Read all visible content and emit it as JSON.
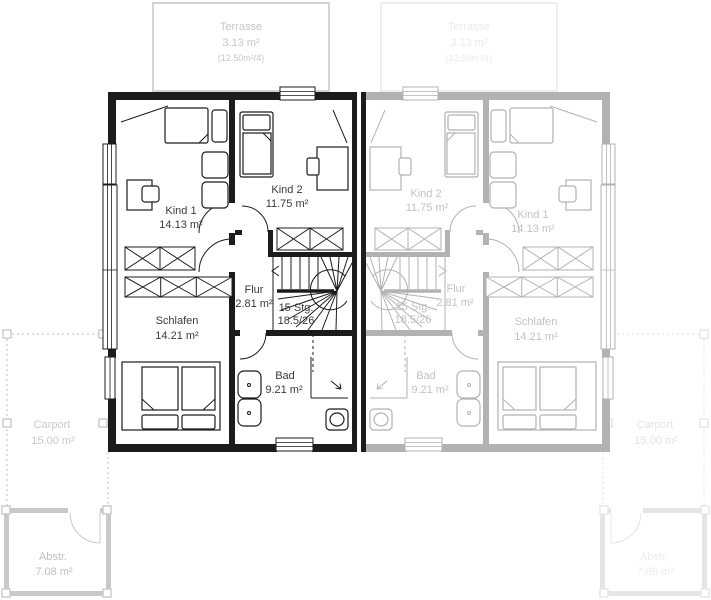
{
  "plan": {
    "rooms": {
      "terrasse": {
        "name": "Terrasse",
        "area": "3.13 m²",
        "note": "(12.50m²/4)"
      },
      "kind1": {
        "name": "Kind 1",
        "area": "14.13 m²"
      },
      "kind2": {
        "name": "Kind 2",
        "area": "11.75 m²"
      },
      "flur": {
        "name": "Flur",
        "area": "2.81 m²"
      },
      "schlafen": {
        "name": "Schlafen",
        "area": "14.21 m²"
      },
      "bad": {
        "name": "Bad",
        "area": "9.21 m²"
      },
      "carport": {
        "name": "Carport",
        "area": "15.00 m²"
      },
      "abstellraum": {
        "name": "Abstr.",
        "area": "7.08 m²"
      }
    },
    "stairs": {
      "line1": "15 Stg.",
      "line2": "18.5/26"
    },
    "colors": {
      "active_unit": "#1c1c1c",
      "ghost_unit": "#b2b2b2",
      "terrace_left": "#d4d4d4",
      "terrace_right": "#eeeeee",
      "outside_left": "#c9c9c9",
      "outside_right": "#e5e5e5",
      "label_dark": "#3a3a3a",
      "label_ghost": "#c2c2c2"
    }
  }
}
